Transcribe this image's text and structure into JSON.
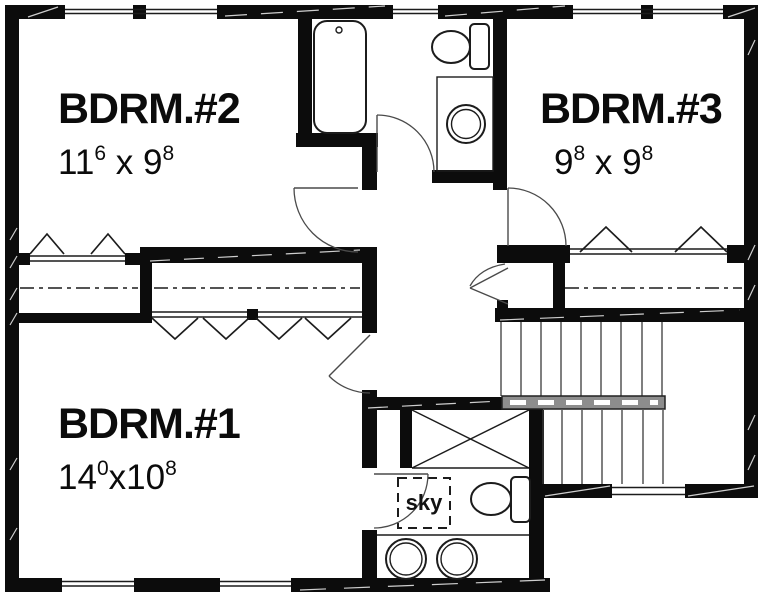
{
  "plan": {
    "rooms": [
      {
        "id": "bdrm2",
        "name": "BDRM.#2",
        "dim": {
          "n1": "11",
          "s1": "6",
          "mid": " x ",
          "n2": "9",
          "s2": "8"
        }
      },
      {
        "id": "bdrm3",
        "name": "BDRM.#3",
        "dim": {
          "n1": "9",
          "s1": "8",
          "mid": " x ",
          "n2": "9",
          "s2": "8"
        }
      },
      {
        "id": "bdrm1",
        "name": "BDRM.#1",
        "dim": {
          "n1": "14",
          "s1": "0",
          "mid": "x",
          "n2": "10",
          "s2": "8"
        }
      }
    ],
    "labels": {
      "skylight": "sky"
    },
    "fixtures": [
      "bathtub",
      "toilet",
      "vanity-sink",
      "double-vanity-sinks",
      "linen-closet-x",
      "skylight",
      "staircase",
      "handrail",
      "bifold-closet-doors",
      "door-swing-arc",
      "window"
    ]
  },
  "colors": {
    "bg": "#ffffff",
    "wall": "#0c0c0c",
    "line": "#1c1c1c",
    "arc": "#4a4a4a",
    "tread": "#3a3a3a",
    "rail": "#8d8d8d"
  }
}
